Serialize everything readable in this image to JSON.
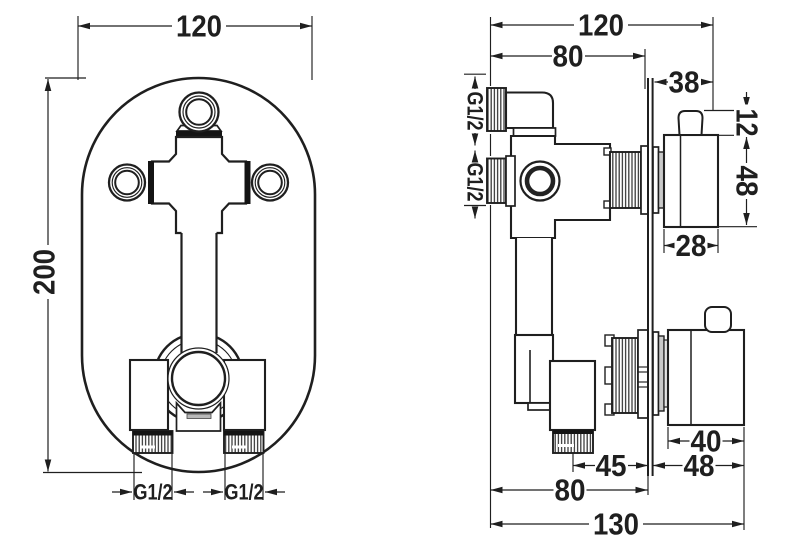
{
  "colors": {
    "background": "#ffffff",
    "line": "#1f1f1f"
  },
  "front_view": {
    "plate_width": "120",
    "plate_height": "200",
    "bottom_outlet_left": "G1/2",
    "bottom_outlet_right": "G1/2"
  },
  "side_view": {
    "total_width": "120",
    "valve_depth": "80",
    "upper_handle_offset": "38",
    "upper_handle_cap_height": "12",
    "upper_handle_height": "48",
    "upper_handle_width": "28",
    "upper_inlet_thread": "G1/2",
    "lower_inlet_thread": "G1/2",
    "lower_handle_width": "40",
    "outlet_to_plate": "45",
    "lower_handle_depth": "48",
    "valve_depth_bottom": "80",
    "total_depth": "130"
  }
}
